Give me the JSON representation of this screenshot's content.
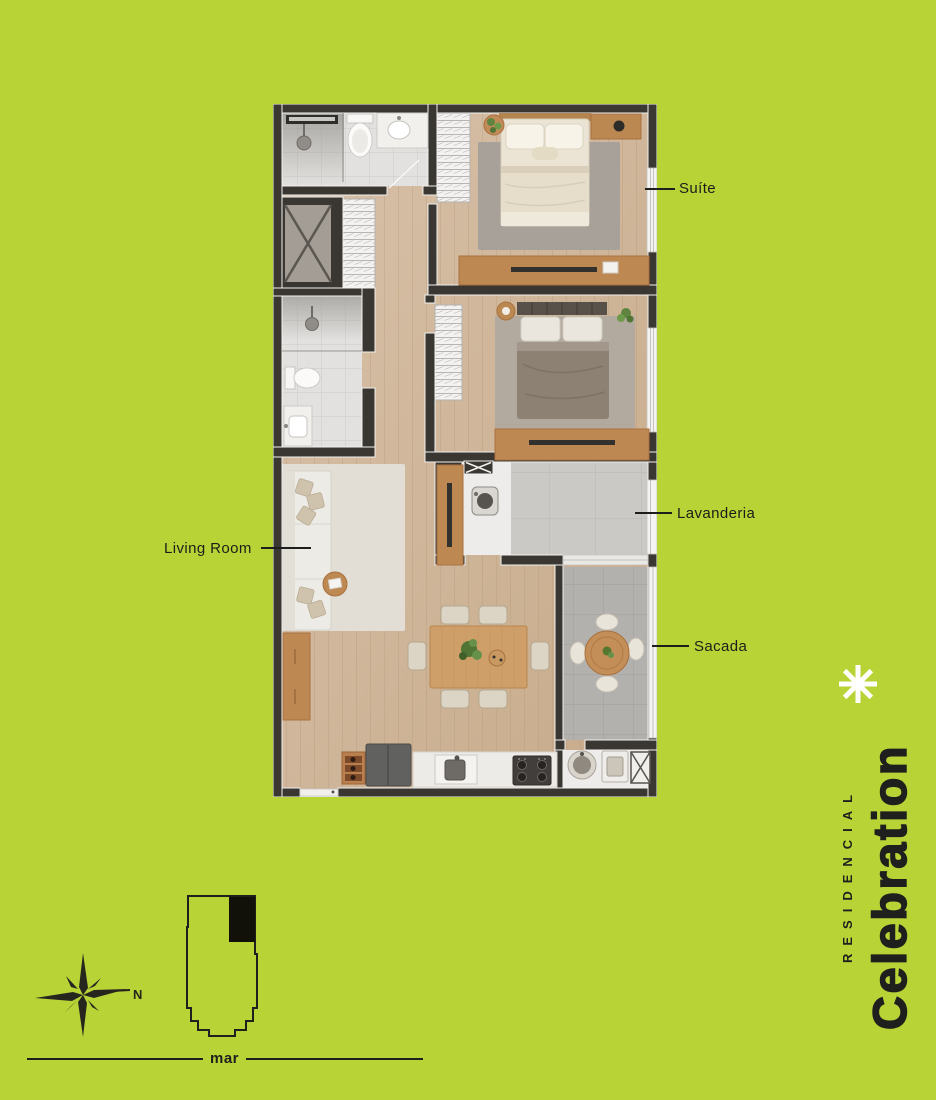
{
  "poster": {
    "type": "residential-floor-plan-marketing-poster"
  },
  "floorplan": {
    "labels": {
      "suite": "Suíte",
      "lavanderia": "Lavanderia",
      "sacada": "Sacada",
      "living_room": "Living Room"
    },
    "rooms_depicted": [
      "suite-bedroom",
      "second-bedroom",
      "bathroom-1",
      "bathroom-2",
      "hall-closet",
      "shaft",
      "living-room",
      "dining-area",
      "kitchen",
      "lavanderia-laundry",
      "sacada-balcony",
      "service-area"
    ]
  },
  "brand": {
    "residencial": "RESIDENCIAL",
    "name": "Celebration",
    "logo_icon": "asterisk-star-icon",
    "text_color": "#1f1f1d",
    "logo_color": "#ffffff"
  },
  "locator": {
    "north_label": "N",
    "sea_label": "mar",
    "compass_icon": "compass-rose-icon",
    "building_icon": "building-footprint-unit-highlight"
  },
  "colors": {
    "background": "#b8d336",
    "ink": "#1d1d1b",
    "wall": "#3a3733",
    "wood_floor": "#d0b89e",
    "furniture_wood": "#bd8852",
    "logo_white": "#ffffff"
  }
}
